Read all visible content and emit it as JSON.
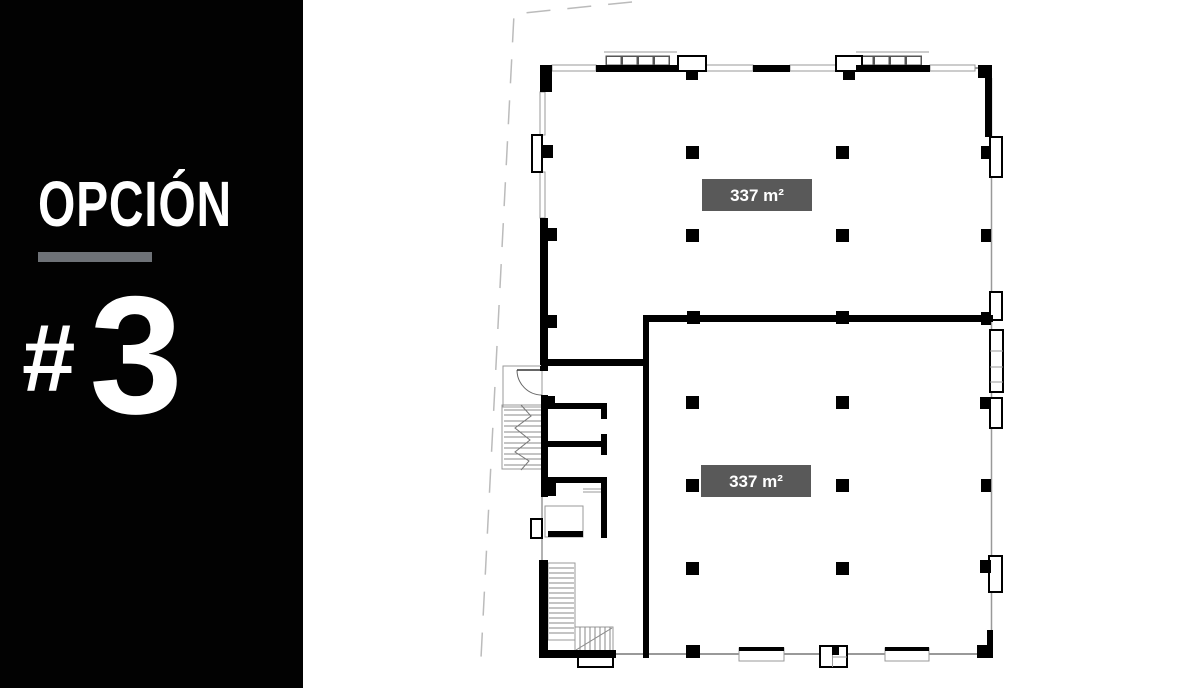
{
  "sidebar": {
    "title": "OPCIÓN",
    "number_prefix": "#",
    "number": "3",
    "background_color": "#020202",
    "text_color": "#ffffff",
    "accent_bar_color": "#6e7277"
  },
  "floor_plan": {
    "units": [
      {
        "name": "upper-unit",
        "area_label": "337 m²"
      },
      {
        "name": "lower-unit",
        "area_label": "337 m²"
      }
    ],
    "area_label_bg_color": "#595959",
    "area_label_text_color": "#ffffff",
    "wall_color": "#000000",
    "window_line_color": "#999999",
    "boundary_line_color": "#bbbbbb",
    "background_color": "#ffffff"
  }
}
